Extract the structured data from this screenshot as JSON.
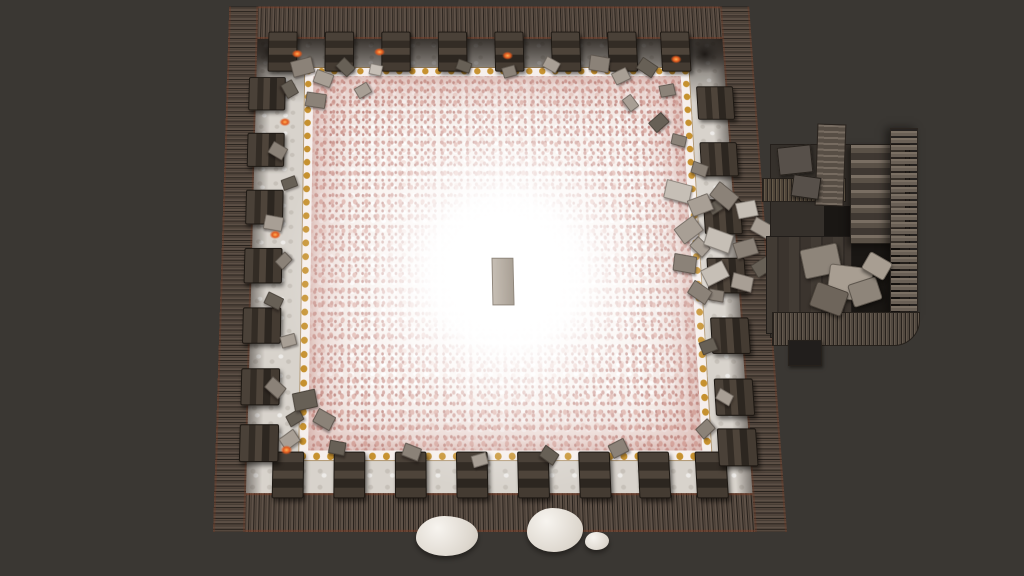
{
  "app": {
    "type": "game-screenshot",
    "view": "top-down-room",
    "visible_text": "none"
  },
  "palette": {
    "background": "#3a3733",
    "wall_stone": "#574a40",
    "wall_edge_red": "#7a3e28",
    "floor_light": "#d8d3cc",
    "gold_trim": "#c6912f",
    "flower_base": "#f7f0ec",
    "flower_speckle": [
      "#cf9d96",
      "#dfb3ab",
      "#c08b85",
      "#eed5ce"
    ],
    "center_glow": "#ffffff",
    "altar_gray": "#b5ada2",
    "ember_orange": "#e05a1f",
    "annex_wood": "#3b342e",
    "annex_stone": "#7a6f63",
    "boulder_white": "#efece6"
  },
  "scene": {
    "room": {
      "left": 213,
      "top": -1,
      "width": 574,
      "height": 533,
      "wall_thickness": 34,
      "perspective_deg": 10.1
    },
    "gold_frame": {
      "x": 85,
      "y": 68,
      "w": 404,
      "h": 384
    },
    "glow_center": {
      "x_pct": 51,
      "y_pct": 54
    },
    "altar": {
      "x": 284,
      "y": 268,
      "w": 21,
      "h": 46
    },
    "pillars": {
      "top": {
        "y": 28,
        "w": 30,
        "h": 42,
        "xs": [
          44,
          106,
          168,
          230,
          292,
          354,
          416,
          474
        ]
      },
      "bottom": {
        "y": 458,
        "w": 30,
        "h": 42,
        "xs": [
          58,
          120,
          182,
          244,
          306,
          368,
          428,
          486
        ]
      },
      "left": {
        "x": 24,
        "w": 38,
        "h": 34,
        "ys": [
          78,
          138,
          198,
          258,
          318,
          378,
          432
        ]
      },
      "right": {
        "x": 510,
        "w": 38,
        "h": 34,
        "ys": [
          88,
          148,
          208,
          268,
          328,
          388,
          436
        ]
      }
    },
    "embers": [
      [
        70,
        48
      ],
      [
        160,
        46
      ],
      [
        300,
        50
      ],
      [
        484,
        54
      ],
      [
        58,
        122
      ],
      [
        50,
        240
      ],
      [
        66,
        452
      ]
    ],
    "debris": [
      [
        70,
        58,
        22,
        16,
        -15,
        1
      ],
      [
        95,
        72,
        18,
        13,
        20,
        0
      ],
      [
        120,
        60,
        16,
        12,
        45,
        2
      ],
      [
        86,
        95,
        20,
        14,
        8,
        1
      ],
      [
        140,
        86,
        14,
        11,
        -30,
        0
      ],
      [
        60,
        84,
        15,
        12,
        60,
        2
      ],
      [
        155,
        64,
        12,
        10,
        12,
        3
      ],
      [
        250,
        60,
        14,
        10,
        20,
        2
      ],
      [
        300,
        66,
        13,
        10,
        -15,
        1
      ],
      [
        345,
        58,
        15,
        11,
        30,
        0
      ],
      [
        395,
        55,
        20,
        15,
        10,
        1
      ],
      [
        420,
        70,
        16,
        12,
        -25,
        0
      ],
      [
        448,
        60,
        18,
        13,
        35,
        2
      ],
      [
        470,
        86,
        15,
        11,
        -10,
        1
      ],
      [
        430,
        100,
        14,
        10,
        55,
        0
      ],
      [
        458,
        120,
        17,
        12,
        -40,
        2
      ],
      [
        480,
        140,
        14,
        10,
        15,
        1
      ],
      [
        48,
        150,
        16,
        12,
        30,
        1
      ],
      [
        62,
        185,
        14,
        10,
        -20,
        2
      ],
      [
        44,
        225,
        18,
        13,
        10,
        0
      ],
      [
        58,
        265,
        13,
        10,
        -45,
        1
      ],
      [
        47,
        305,
        16,
        11,
        25,
        2
      ],
      [
        64,
        345,
        14,
        10,
        -15,
        0
      ],
      [
        50,
        390,
        17,
        12,
        40,
        1
      ],
      [
        72,
        420,
        14,
        10,
        -30,
        2
      ],
      [
        78,
        400,
        22,
        16,
        -12,
        2
      ],
      [
        100,
        420,
        18,
        13,
        28,
        1
      ],
      [
        66,
        440,
        16,
        12,
        -35,
        0
      ],
      [
        115,
        448,
        15,
        11,
        10,
        2
      ],
      [
        190,
        452,
        16,
        11,
        20,
        1
      ],
      [
        260,
        460,
        14,
        10,
        -15,
        0
      ],
      [
        330,
        455,
        15,
        11,
        35,
        2
      ],
      [
        400,
        448,
        16,
        12,
        -25,
        1
      ],
      [
        500,
        170,
        15,
        11,
        20,
        1
      ],
      [
        515,
        210,
        13,
        10,
        -30,
        2
      ],
      [
        495,
        250,
        16,
        12,
        45,
        0
      ],
      [
        510,
        300,
        14,
        10,
        10,
        1
      ],
      [
        498,
        350,
        15,
        11,
        -20,
        2
      ],
      [
        512,
        400,
        14,
        10,
        30,
        0
      ],
      [
        490,
        430,
        15,
        11,
        -40,
        1
      ],
      [
        470,
        190,
        26,
        18,
        15,
        3
      ],
      [
        495,
        205,
        22,
        16,
        -20,
        0
      ],
      [
        520,
        195,
        24,
        17,
        40,
        1
      ],
      [
        545,
        210,
        20,
        15,
        -10,
        3
      ],
      [
        480,
        230,
        24,
        17,
        -35,
        0
      ],
      [
        510,
        240,
        26,
        18,
        20,
        3
      ],
      [
        540,
        250,
        22,
        15,
        -15,
        1
      ],
      [
        560,
        230,
        20,
        14,
        30,
        0
      ],
      [
        475,
        265,
        22,
        16,
        10,
        1
      ],
      [
        505,
        275,
        24,
        16,
        -25,
        3
      ],
      [
        535,
        285,
        20,
        14,
        15,
        0
      ],
      [
        558,
        270,
        18,
        13,
        -30,
        2
      ],
      [
        490,
        295,
        20,
        14,
        35,
        1
      ]
    ],
    "annex": {
      "left": 762,
      "top": 118,
      "width": 168,
      "height": 250,
      "parts": [
        {
          "cls": "ax-floor",
          "name": "annex-floor",
          "x": 8,
          "y": 26,
          "w": 138,
          "h": 192,
          "rot": 0
        },
        {
          "cls": "ax-shadow",
          "name": "annex-inner-shadow",
          "x": 62,
          "y": 88,
          "w": 76,
          "h": 126,
          "rot": 0
        },
        {
          "cls": "ax-planks",
          "name": "annex-plank-floor",
          "x": 4,
          "y": 118,
          "w": 84,
          "h": 96,
          "rot": 0
        },
        {
          "cls": "ax-beam",
          "name": "annex-cross-beam",
          "x": 0,
          "y": 60,
          "w": 82,
          "h": 22,
          "rot": 0
        },
        {
          "cls": "ax-stairs",
          "name": "annex-staircase",
          "x": 88,
          "y": 26,
          "w": 54,
          "h": 98,
          "rot": 0
        },
        {
          "cls": "ax-slab",
          "name": "annex-wall-slab",
          "x": 54,
          "y": 6,
          "w": 27,
          "h": 80,
          "rot": 2
        },
        {
          "cls": "ax-block",
          "name": "annex-stone-block",
          "x": 16,
          "y": 28,
          "w": 32,
          "h": 26,
          "rot": -6
        },
        {
          "cls": "ax-block",
          "name": "annex-stone-block",
          "x": 30,
          "y": 58,
          "w": 26,
          "h": 20,
          "rot": 8
        },
        {
          "cls": "ax-wallr",
          "name": "annex-east-wall",
          "x": 128,
          "y": 10,
          "w": 26,
          "h": 185,
          "rot": 0
        },
        {
          "cls": "ax-wallb",
          "name": "annex-south-wall",
          "x": 10,
          "y": 194,
          "w": 146,
          "h": 32,
          "rot": 0
        },
        {
          "cls": "ax-rubble ra",
          "name": "annex-rubble",
          "x": 40,
          "y": 128,
          "w": 36,
          "h": 28,
          "rot": -12
        },
        {
          "cls": "ax-rubble rb",
          "name": "annex-rubble",
          "x": 66,
          "y": 148,
          "w": 42,
          "h": 32,
          "rot": 7
        },
        {
          "cls": "ax-rubble rc",
          "name": "annex-rubble",
          "x": 50,
          "y": 168,
          "w": 32,
          "h": 24,
          "rot": 20
        },
        {
          "cls": "ax-rubble ra",
          "name": "annex-rubble",
          "x": 88,
          "y": 162,
          "w": 28,
          "h": 22,
          "rot": -18
        },
        {
          "cls": "ax-rubble rb",
          "name": "annex-rubble",
          "x": 102,
          "y": 138,
          "w": 24,
          "h": 18,
          "rot": 30
        },
        {
          "cls": "ax-block dark",
          "name": "annex-shadow-block",
          "x": 26,
          "y": 222,
          "w": 32,
          "h": 24,
          "rot": 0
        }
      ]
    },
    "boulders": [
      {
        "x": 416,
        "y": 516,
        "w": 62,
        "h": 40
      },
      {
        "x": 527,
        "y": 508,
        "w": 56,
        "h": 44
      },
      {
        "x": 585,
        "y": 532,
        "w": 24,
        "h": 18
      }
    ]
  }
}
